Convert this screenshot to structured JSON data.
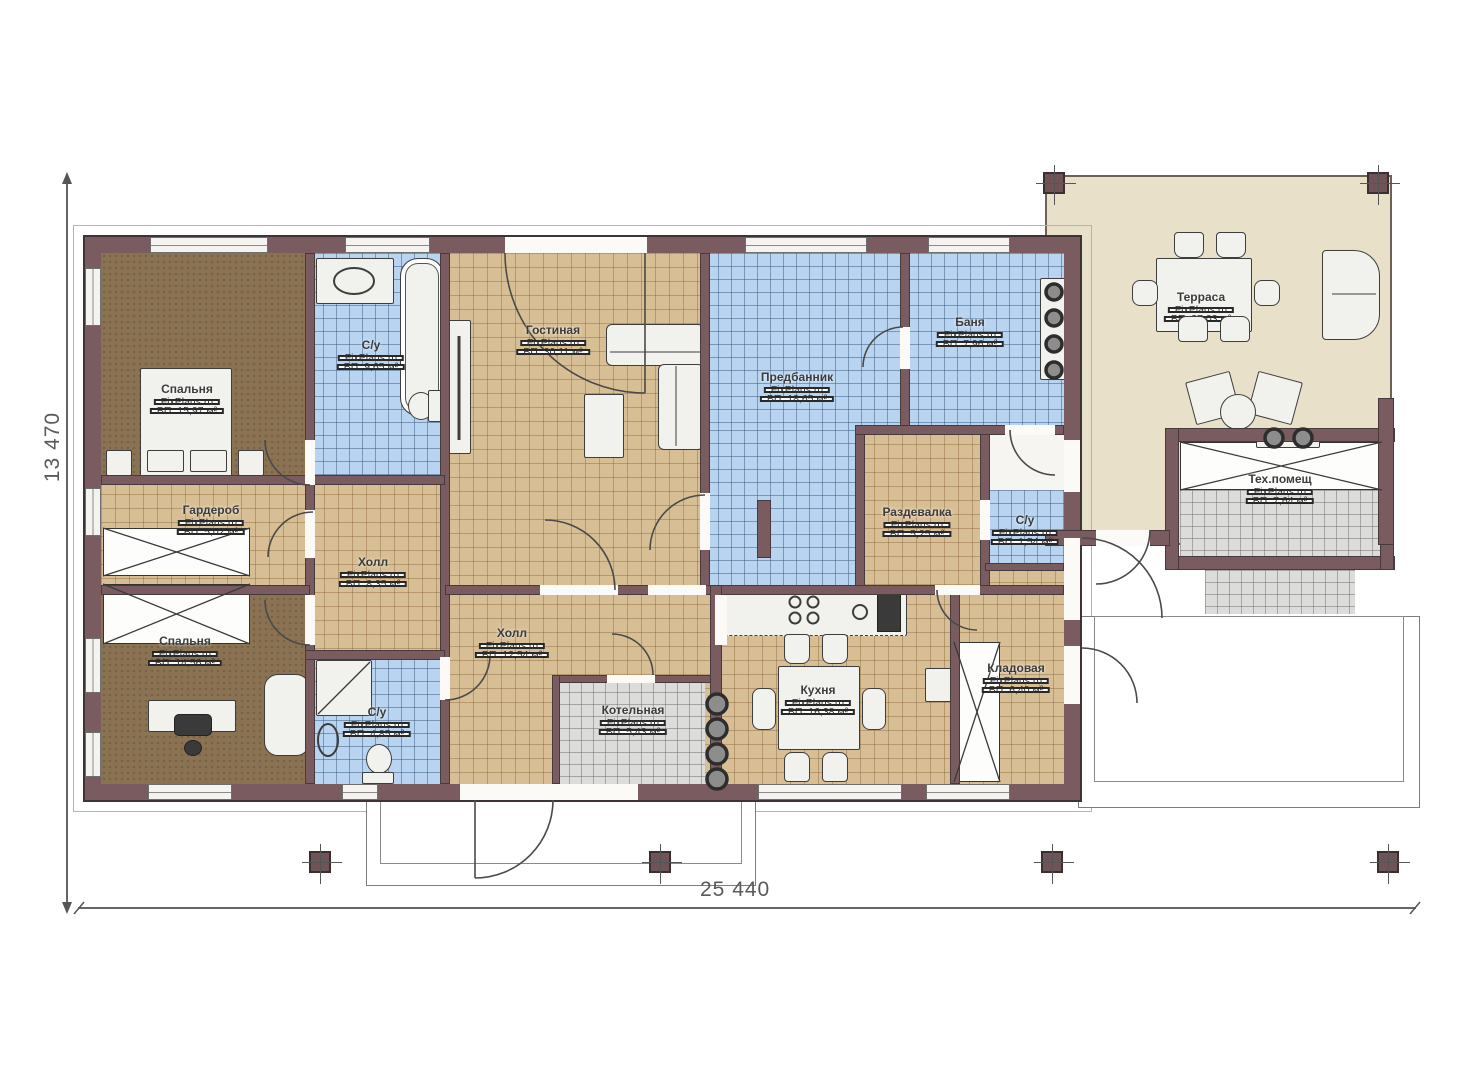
{
  "plan": {
    "watermark": "FixPlans.ru",
    "dimensions": {
      "height_label": "13 470",
      "width_label": "25 440"
    },
    "palette": {
      "wall": "#7a5c60",
      "wood_floor": "#d8be94",
      "tile_blue": "#b9d4f0",
      "tile_grey": "#dcdcda",
      "bedroom_brown": "#8a7253",
      "terrace_beige": "#e9e0ca"
    },
    "rooms": [
      {
        "id": "bedroom-1",
        "name": "Спальня",
        "area": "ВП: 15,97 м²"
      },
      {
        "id": "bathroom-1",
        "name": "С/у",
        "area": "ВП: 9,65 м²"
      },
      {
        "id": "living-room",
        "name": "Гостиная",
        "area": "ВП: 30,11 м²"
      },
      {
        "id": "predbannik",
        "name": "Предбанник",
        "area": "ВП: 18,65 м²"
      },
      {
        "id": "banya",
        "name": "Баня",
        "area": "ВП: 7,96 м²"
      },
      {
        "id": "terrace",
        "name": "Терраса",
        "area": "ВП: 37,03 м²"
      },
      {
        "id": "wardrobe",
        "name": "Гардероб",
        "area": "ВП: 5,02 м²"
      },
      {
        "id": "hall-1",
        "name": "Холл",
        "area": "ВП: 8,35 м²"
      },
      {
        "id": "razdevalka",
        "name": "Раздевалка",
        "area": "ВП: 5,25 м²"
      },
      {
        "id": "bathroom-2",
        "name": "С/у",
        "area": "ВП: 1,54 м²"
      },
      {
        "id": "tech-room",
        "name": "Тех.помещ",
        "area": "ВП: 7,64 м²"
      },
      {
        "id": "bedroom-2",
        "name": "Спальня",
        "area": "ВП: 14,56 м²"
      },
      {
        "id": "hall-2",
        "name": "Холл",
        "area": "ВП: 12,54 м²"
      },
      {
        "id": "bathroom-3",
        "name": "С/у",
        "area": "ВП: 4,85 м²"
      },
      {
        "id": "boiler-room",
        "name": "Котельная",
        "area": "ВП: 5,43 м²"
      },
      {
        "id": "kitchen",
        "name": "Кухня",
        "area": "ВП: 16,38 м²"
      },
      {
        "id": "storage",
        "name": "Кладовая",
        "area": "ВП: 6,40 м²"
      }
    ]
  }
}
